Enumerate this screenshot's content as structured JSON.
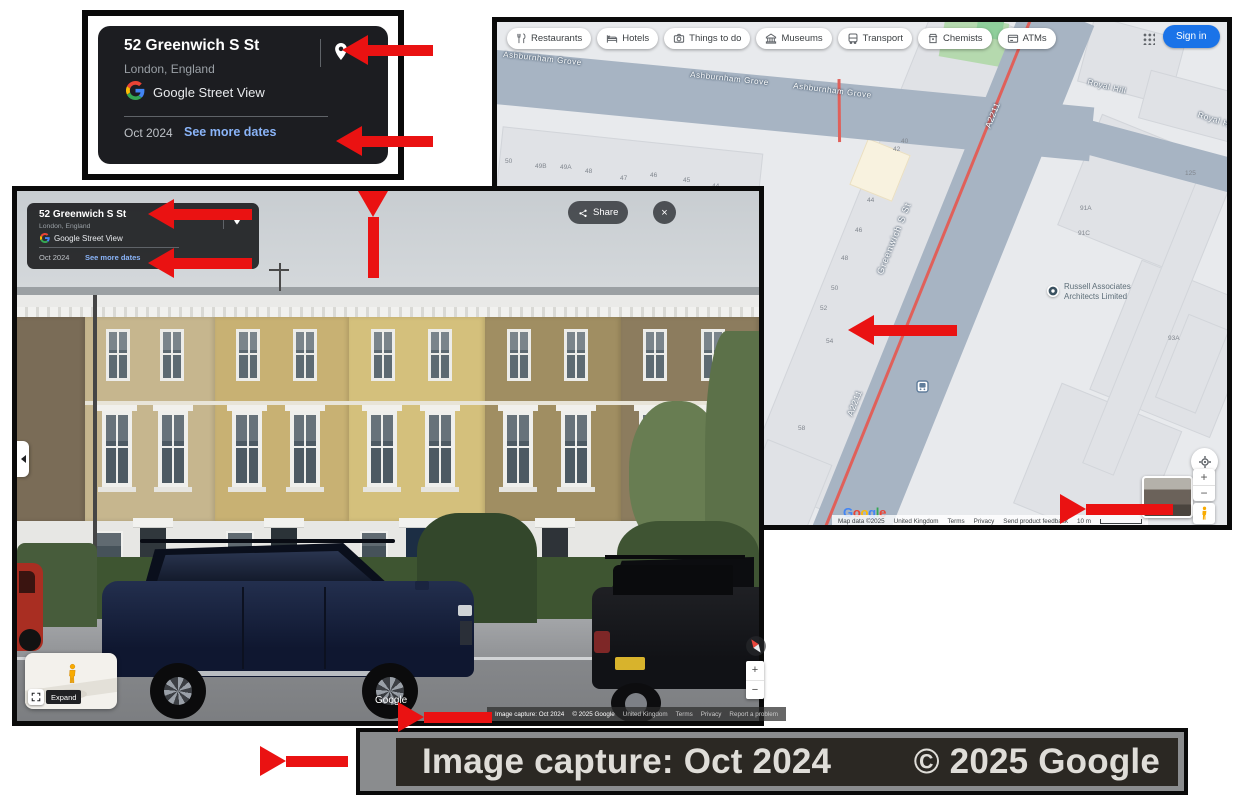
{
  "annotation_card": {
    "title": "52 Greenwich S St",
    "subtitle": "London, England",
    "brand": "Google Street View",
    "date": "Oct 2024",
    "see_more": "See more dates"
  },
  "map": {
    "chips": [
      {
        "icon": "restaurants-icon",
        "label": "Restaurants"
      },
      {
        "icon": "hotels-icon",
        "label": "Hotels"
      },
      {
        "icon": "things-to-do-icon",
        "label": "Things to do"
      },
      {
        "icon": "museums-icon",
        "label": "Museums"
      },
      {
        "icon": "transport-icon",
        "label": "Transport"
      },
      {
        "icon": "chemists-icon",
        "label": "Chemists"
      },
      {
        "icon": "atms-icon",
        "label": "ATMs"
      }
    ],
    "sign_in": "Sign in",
    "labels": {
      "ashburnham": "Ashburnham Grove",
      "greenwich": "Greenwich S St",
      "a2211": "A2211",
      "royal_hill": "Royal Hill"
    },
    "poi": {
      "line1": "Russell Associates",
      "line2": "Architects Limited"
    },
    "numbers_top": [
      "50",
      "49B",
      "49A",
      "48",
      "47",
      "46",
      "45",
      "44"
    ],
    "numbers_west": [
      "40",
      "42",
      "44",
      "46",
      "48",
      "50",
      "52",
      "54",
      "58"
    ],
    "numbers_east": [
      "125",
      "91A",
      "91C",
      "93A"
    ],
    "attribution": {
      "brand": "Google",
      "map_data": "Map data ©2025",
      "region": "United Kingdom",
      "terms": "Terms",
      "privacy": "Privacy",
      "feedback": "Send product feedback",
      "scale": "10 m"
    }
  },
  "streetview": {
    "card": {
      "title": "52 Greenwich S St",
      "subtitle": "London, England",
      "brand": "Google Street View",
      "date": "Oct 2024",
      "see_more": "See more dates"
    },
    "share_label": "Share",
    "close_glyph": "×",
    "expand_label": "Expand",
    "watermark": "Google",
    "attribution": {
      "capture": "Image capture: Oct 2024",
      "copyright": "© 2025 Google",
      "region": "United Kingdom",
      "terms": "Terms",
      "privacy": "Privacy",
      "report": "Report a problem"
    }
  },
  "zoom_strip": {
    "capture": "Image capture: Oct 2024",
    "copyright": "© 2025 Google"
  },
  "controls": {
    "zoom_in": "+",
    "zoom_out": "−"
  },
  "colors": {
    "arrow": "#ea1212",
    "sign_in_bg": "#1a73e8",
    "link": "#8ab4f8",
    "road": "#a7b4c3",
    "map_bg": "#e8eaed"
  }
}
